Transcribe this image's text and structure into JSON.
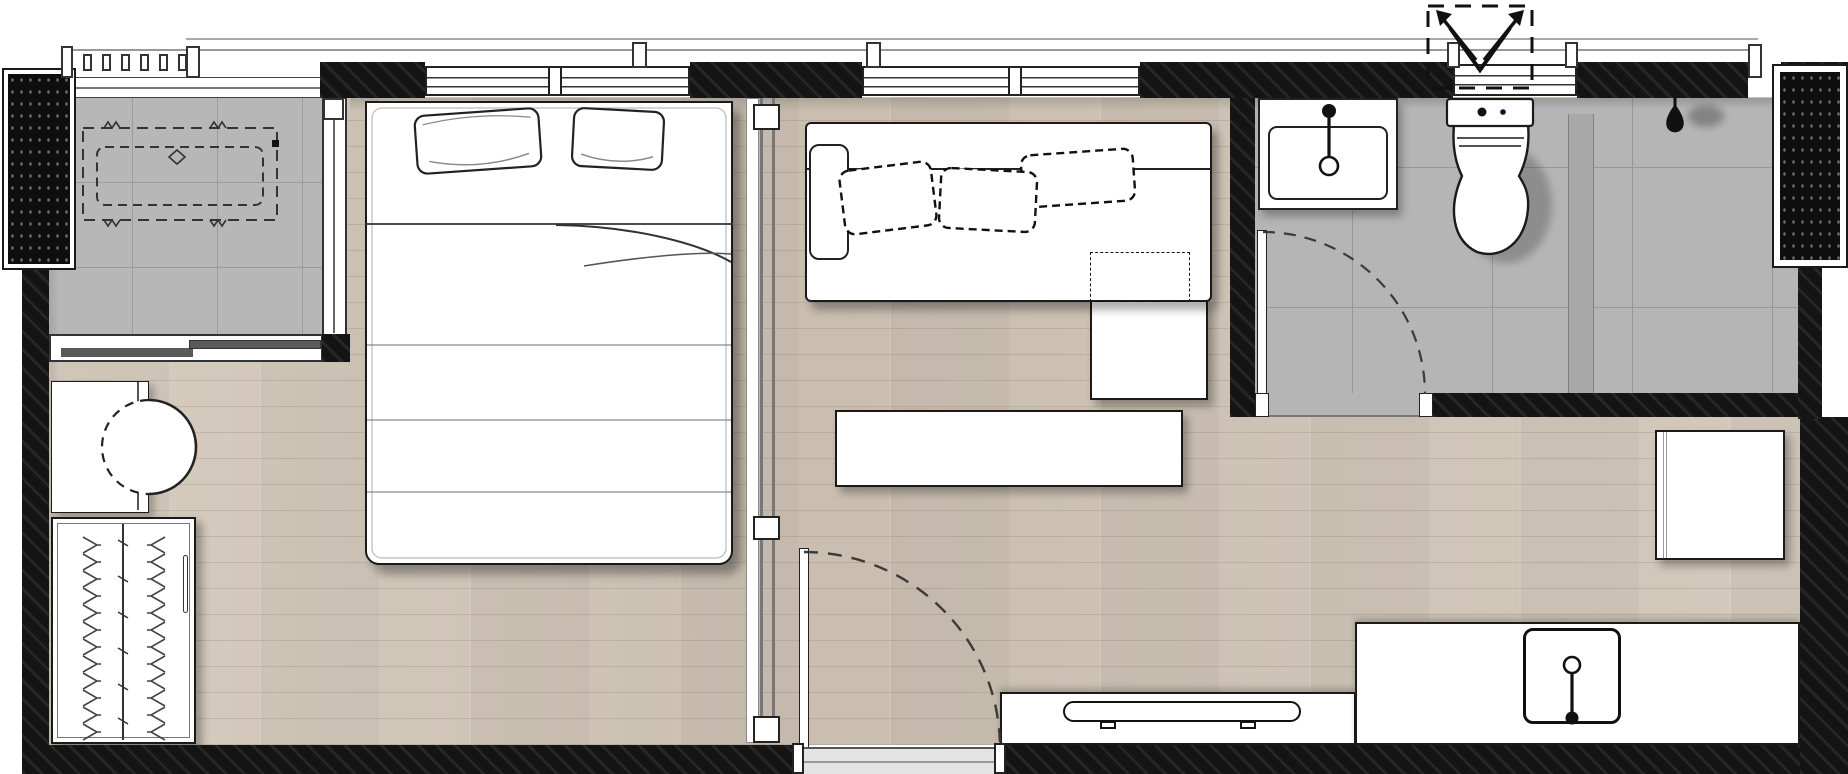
{
  "document": {
    "title": "Studio apartment floor plan"
  },
  "colors": {
    "wall": "#141414",
    "wood_floor": "#cfc5b7",
    "balcony_tile": "#b7b7b7",
    "bathroom_tile": "#b5b5b5",
    "outline": "#1a1a1a",
    "glass_screen": "#a9a9a9",
    "shadow": "rgba(0,0,0,0.35)"
  },
  "rooms": {
    "balcony": {
      "label": "Balcony (tiled)"
    },
    "bedroom": {
      "label": "Bedroom"
    },
    "living": {
      "label": "Living area"
    },
    "bathroom": {
      "label": "Bathroom (tiled)"
    },
    "kitchen": {
      "label": "Kitchen"
    },
    "entrance": {
      "label": "Entrance"
    }
  },
  "furniture": {
    "ac_unit": {
      "label": "Air-conditioner condenser (dashed outline)"
    },
    "bed": {
      "label": "Double bed with two pillows and folded blanket"
    },
    "pillow_count": 2,
    "desk": {
      "label": "Desk"
    },
    "chair": {
      "label": "Round chair (half hidden under desk, dashed)"
    },
    "wardrobe": {
      "label": "Wardrobe with clothes hangers"
    },
    "sofa": {
      "label": "Sofa with three loose cushions"
    },
    "cushion_count": 3,
    "chaise": {
      "label": "Sofa chaise / ottoman"
    },
    "dashed_table": {
      "label": "Dashed furniture outline on sofa"
    },
    "coffee_table": {
      "label": "Coffee table"
    },
    "tv": {
      "label": "TV on low cabinet"
    },
    "refrigerator": {
      "label": "Refrigerator"
    }
  },
  "fixtures": {
    "kitchen_counter": {
      "label": "L-shaped kitchen counter"
    },
    "kitchen_sink": {
      "label": "Kitchen sink with faucet"
    },
    "vanity": {
      "label": "Bathroom washbasin with faucet"
    },
    "toilet": {
      "label": "Toilet with cistern"
    },
    "shower": {
      "label": "Shower head"
    },
    "shower_screen": {
      "label": "Shower glass screen"
    },
    "sliding_partition": {
      "label": "Sliding partition between bedroom and living area"
    },
    "entrance_door": {
      "label": "Entrance swing door (dashed arc)"
    },
    "bathroom_door": {
      "label": "Bathroom swing door (dashed arc)"
    },
    "balcony_window": {
      "label": "Balcony sliding window"
    },
    "balcony_glass": {
      "label": "Balcony glass partition"
    },
    "bedroom_window": {
      "label": "Bedroom window"
    },
    "living_window": {
      "label": "Living room window"
    },
    "toilet_window": {
      "label": "Bathroom ventilation window"
    },
    "vent_symbol": {
      "label": "Open-above shaft symbol (dashed square with arrows)"
    },
    "railing": {
      "label": "Balcony railing with balusters"
    },
    "column_west": {
      "label": "Structural column / AC ledge (west)"
    },
    "column_east": {
      "label": "Structural column / shaft (east)"
    }
  }
}
